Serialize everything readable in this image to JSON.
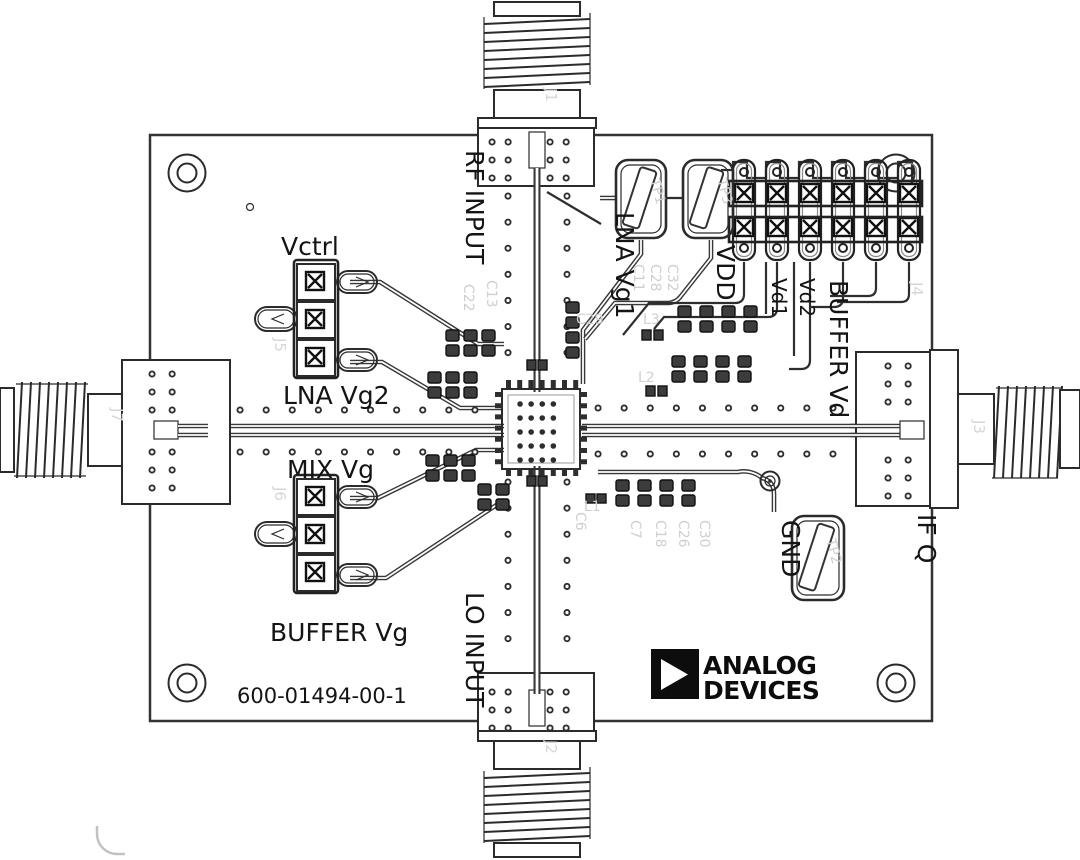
{
  "board": {
    "part_number": "600-01494-00-1",
    "description": "Analog Devices evaluation board assembly drawing"
  },
  "logo": {
    "line1": "ANALOG",
    "line2": "DEVICES"
  },
  "labels": {
    "rf_input": "RF INPUT",
    "lo_input": "LO INPUT",
    "if_q": "IF Q",
    "vctrl": "Vctrl",
    "lna_vg2": "LNA Vg2",
    "mix_vg": "MIX Vg",
    "buffer_vg": "BUFFER Vg",
    "lna_vg1": "LNA Vg1",
    "vdd": "VDD",
    "vd1": "Vd1",
    "vd2": "Vd2",
    "buffer_vd": "BUFFER Vd",
    "gnd": "GND"
  },
  "silkscreen": {
    "j1": "J1",
    "j2": "J2",
    "j3": "J3",
    "j4": "J4",
    "j5": "J5",
    "j6": "J6",
    "j7": "J7",
    "tp1": "TP1",
    "tp2": "TP2",
    "tp3": "TP3",
    "c6": "C6",
    "c7": "C7",
    "c11": "C11",
    "c13": "C13",
    "c18": "C18",
    "c22": "C22",
    "c26": "C26",
    "c28": "C28",
    "c29": "C29",
    "c30": "C30",
    "c32": "C32",
    "l1": "L1",
    "l2": "L2",
    "l3": "L3"
  },
  "colors": {
    "line_art": "#2b2b2b",
    "faint_silkscreen": "#cfcfcf",
    "background": "#ffffff",
    "logo_black": "#0d0d0d"
  }
}
